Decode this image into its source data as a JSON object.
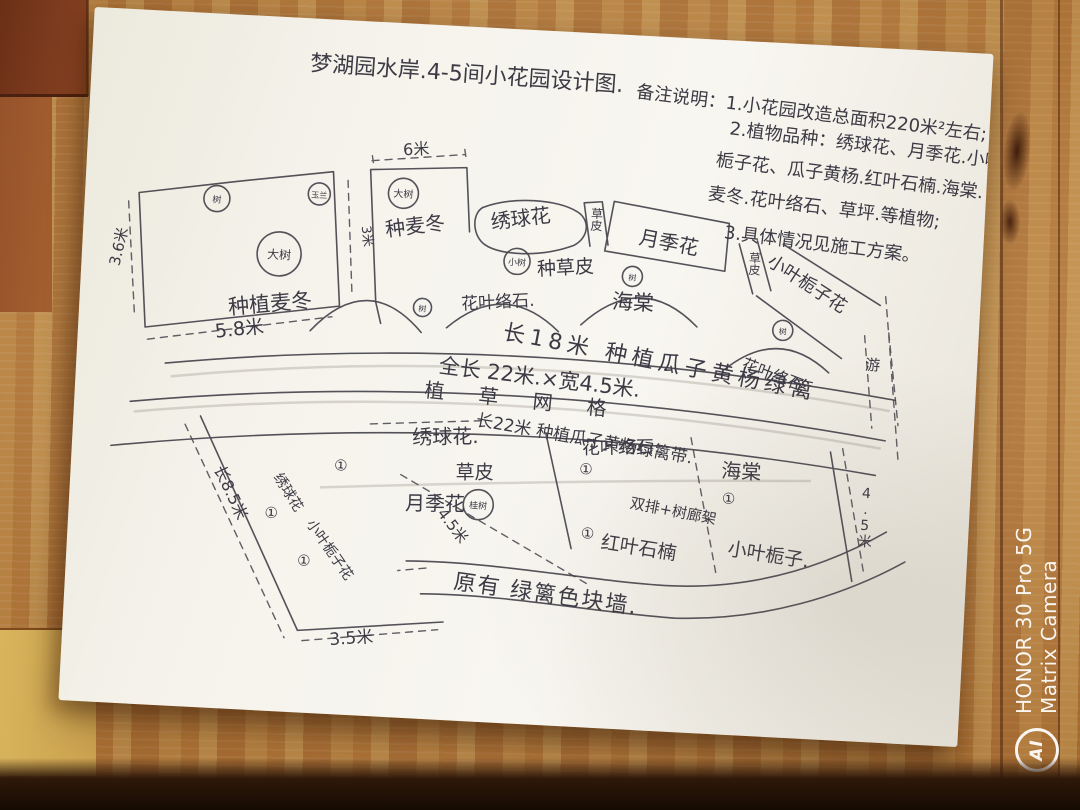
{
  "colors": {
    "ink": "#45434c",
    "paper": "#f5f3ec",
    "wood": "#bd8140",
    "wood_dark_plank": "#6b2f17",
    "floor_shadow": "#150b03",
    "watermark": "#ffffff"
  },
  "watermark": {
    "logo": "AI",
    "line1": "HONOR 30 Pro 5G",
    "line2": "Matrix Camera"
  },
  "sketch": {
    "title": "梦湖园水岸.4-5间小花园设计图.",
    "notes": {
      "line1": "备注说明：1.小花园改造总面积220米²左右;",
      "line2": "2.植物品种：绣球花、月季花.小叶",
      "line3": "栀子花、瓜子黄杨.红叶石楠.海棠.",
      "line4": "麦冬.花叶络石、草坪.等植物;",
      "line5": "3.具体情况见施工方案。"
    },
    "dims": {
      "left_height": "3.6米",
      "left_width": "5.8米",
      "top_width": "6米",
      "strip_width": "3米",
      "lower_left_len": "长8.5米",
      "lower_inner": "4.5米",
      "lower_bottom": "3.5米",
      "lower_right": "4.5米"
    },
    "annotations": {
      "hedge18": "长18米 种植瓜子黄杨绿篱",
      "road_len": "全长 22米.×宽4.5米.",
      "grass_grid": "植 草 网 格",
      "hedge22": "长22米 种植瓜子黄杨绿篱带.",
      "old_wall": "原有 绿篱色块墙.",
      "pergola": "双排+树廊架",
      "path_char": "游"
    },
    "markers": {
      "big_tree": "大树",
      "tree": "树",
      "small_tree": "小树",
      "yulan": "玉兰",
      "gui_tree": "桂树",
      "circle_one": "①"
    },
    "areas": {
      "maidong_plant": "种植麦冬",
      "maidong": "种麦冬",
      "xiuqiu_top": "绣球花",
      "caopi": "草皮",
      "yueji_top": "月季花",
      "zhizi_top": "小叶栀子花",
      "caopi_plant": "种草皮",
      "luoshi_top": "花叶络石.",
      "haitang_top": "海棠",
      "luoshi_right": "花叶络石",
      "xiuqiu_mid": "绣球花.",
      "caopi_mid": "草皮",
      "yueji_mid": "月季花",
      "luoshi_mid": "花叶络石.",
      "haitang_mid": "海棠",
      "hongye": "红叶石楠",
      "zhizi_mid": "小叶栀子.",
      "xiuqiu_left": "绣球花",
      "zhizi_left": "小叶栀子花"
    }
  }
}
